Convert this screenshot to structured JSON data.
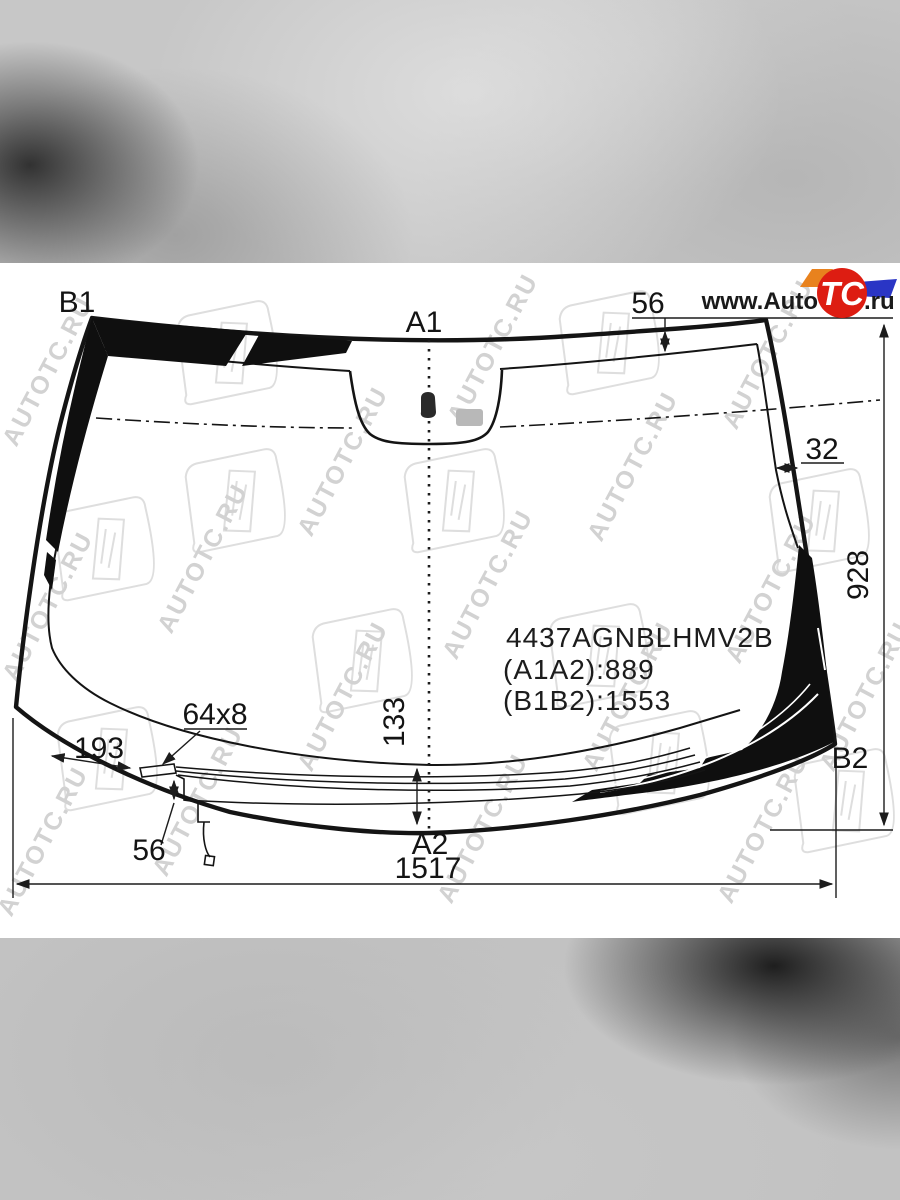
{
  "watermark": {
    "text": "AUTOTC.RU"
  },
  "logo": {
    "www_prefix": "www.Auto",
    "tc": "TC",
    "ru_suffix": ".ru",
    "colors": {
      "red": "#dd1d12",
      "orange": "#e8821e",
      "blue": "#2a35c5"
    }
  },
  "drawing": {
    "part_number": "4437AGNBLHMV2B",
    "dim_a1a2": "(A1A2):889",
    "dim_b1b2": "(B1B2):1553",
    "labels": {
      "b1": "B1",
      "a1": "A1",
      "a2": "A2",
      "b2": "B2"
    },
    "dims": {
      "top_band": "56",
      "side_band": "32",
      "right_height": "928",
      "wiper_zone_height": "133",
      "bottom_width": "1517",
      "connector_offset": "193",
      "connector_size": "64x8",
      "connector_drop": "56"
    },
    "colors": {
      "line": "#141414",
      "frit_black": "#0f0f0f",
      "sensor_gray": "#b8b8b8"
    }
  }
}
